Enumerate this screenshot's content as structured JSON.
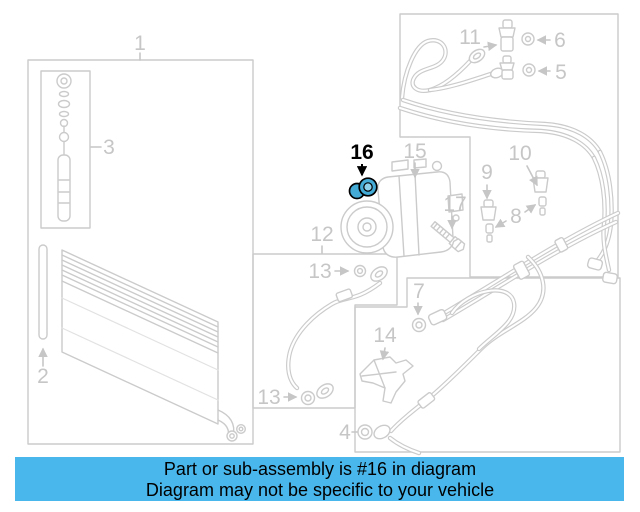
{
  "banner": {
    "line1": "Part or sub-assembly is #16 in diagram",
    "line2": "Diagram may not be specific to your vehicle",
    "bg_color": "#49b7ec",
    "text_color": "#000000"
  },
  "highlight": {
    "part_number": "16",
    "fill": "#44aad6",
    "inner_fill": "#8ed0ea",
    "outline": "#000000"
  },
  "colors": {
    "diagram_line": "#cbcbcb",
    "label_gray": "#c6c6c6",
    "background": "#ffffff"
  },
  "labels": {
    "l1": "1",
    "l2": "2",
    "l3": "3",
    "l4": "4",
    "l5": "5",
    "l6": "6",
    "l7": "7",
    "l8": "8",
    "l9": "9",
    "l10": "10",
    "l11": "11",
    "l12": "12",
    "l13": "13",
    "l14": "14",
    "l15": "15",
    "l16": "16",
    "l17": "17"
  }
}
